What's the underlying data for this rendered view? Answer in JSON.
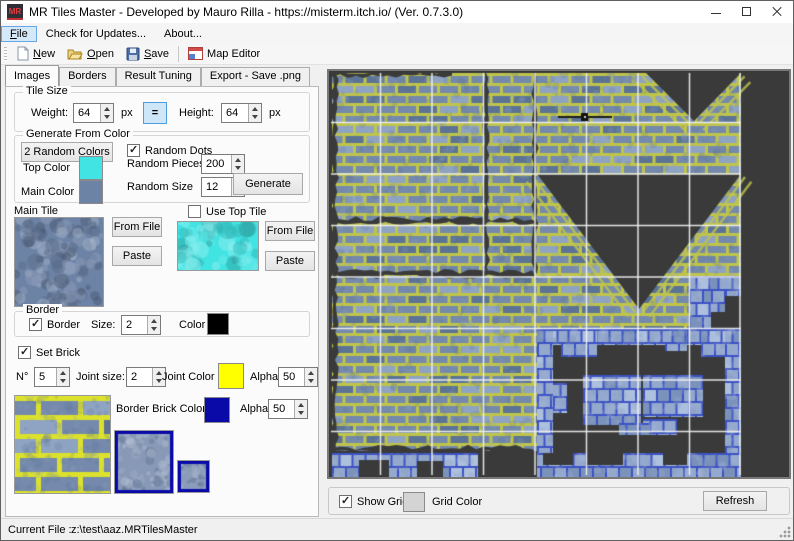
{
  "window": {
    "icon_text": "MR",
    "title": "MR Tiles Master - Developed by Mauro Rilla -  https://misterm.itch.io/ (Ver. 0.7.3.0)"
  },
  "menu": {
    "file": {
      "m": "F",
      "rest": "ile"
    },
    "updates": "Check for Updates...",
    "about": "About..."
  },
  "toolbar": {
    "new": {
      "m": "N",
      "rest": "ew"
    },
    "open": {
      "m": "O",
      "rest": "pen"
    },
    "save": {
      "m": "S",
      "rest": "ave"
    },
    "map_editor": "Map Editor"
  },
  "tabs": {
    "images": "Images",
    "borders": "Borders",
    "result_tuning": "Result Tuning",
    "export": "Export - Save .png"
  },
  "tile_size": {
    "title": "Tile Size",
    "weight_label": "Weight:",
    "weight": "64",
    "px_a": "px",
    "equals": "=",
    "height_label": "Height:",
    "height": "64",
    "px_b": "px"
  },
  "generate": {
    "title": "Generate From Color",
    "random_colors": "2 Random Colors",
    "random_dots": "Random Dots",
    "top_color_label": "Top Color",
    "top_color": "#41E3E3",
    "main_color_label": "Main Color",
    "main_color": "#6D83A6",
    "random_pieces_label": "Random Pieces",
    "random_pieces": "200",
    "random_size_label": "Random Size",
    "random_size": "12",
    "generate_btn": "Generate"
  },
  "main_tile": {
    "title": "Main Tile",
    "from_file": "From File",
    "paste": "Paste",
    "use_top_tile": "Use Top Tile",
    "from_file2": "From File",
    "paste2": "Paste"
  },
  "border": {
    "title": "Border",
    "checkbox": "Border",
    "size_label": "Size:",
    "size": "2",
    "color_label": "Color",
    "color": "#000000"
  },
  "brick": {
    "set_brick": "Set Brick",
    "n_label": "N°",
    "n": "5",
    "joint_size_label": "Joint size:",
    "joint_size": "2",
    "joint_color_label": "Joint Color",
    "joint_color": "#FFFF00",
    "alpha_label": "Alpha",
    "alpha": "50",
    "border_brick_color_label": "Border Brick Color",
    "border_brick_color": "#0A0AA8",
    "alpha2_label": "Alpha",
    "alpha2": "50"
  },
  "map_panel": {
    "show_grid": "Show Grid",
    "grid_color_label": "Grid Color",
    "grid_color_swatch": "#D4D4D4",
    "refresh": "Refresh",
    "background": "#3A3A3A",
    "grid_line": "#F2F2F2",
    "tile": 51.5,
    "cols": 8,
    "rows": 8,
    "brick": {
      "joint": "#BFC44B",
      "base": "#7489AB",
      "light": "#8FA3C2",
      "dark": "#5C7396"
    },
    "small": {
      "joint": "#3C52C4",
      "base": "#94A9CD",
      "light": "#ADC0DE",
      "dark": "#7B92BB"
    }
  },
  "status": {
    "label": "Current File :",
    "value": "z:\\test\\aaz.MRTilesMaster"
  }
}
